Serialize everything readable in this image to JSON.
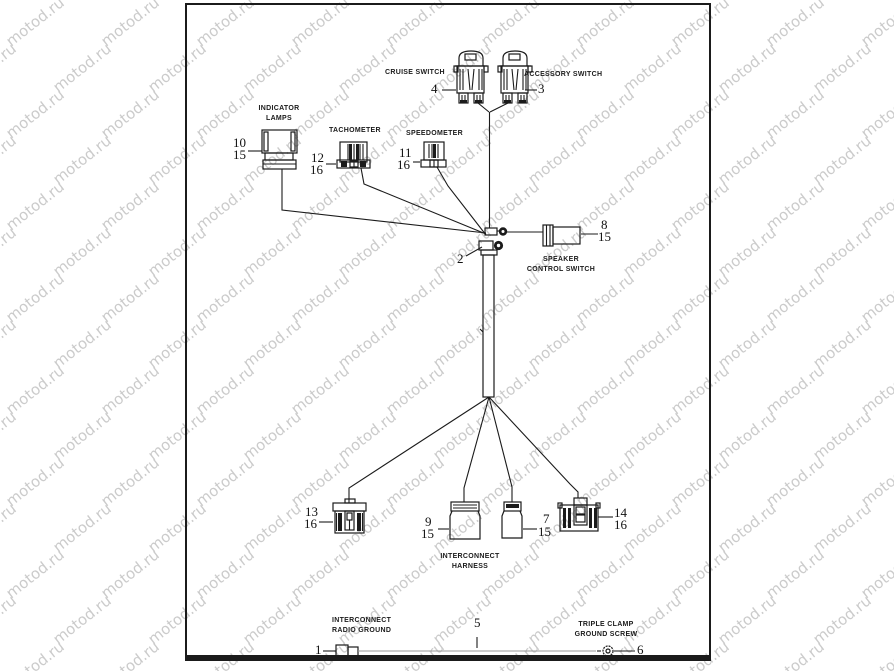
{
  "watermark": {
    "text": "motod.ru",
    "color": "#cbcbcb"
  },
  "labels": {
    "cruise_switch": "CRUISE SWITCH",
    "accessory_switch": "ACCESSORY SWITCH",
    "indicator_lamps": "INDICATOR\nLAMPS",
    "tachometer": "TACHOMETER",
    "speedometer": "SPEEDOMETER",
    "speaker_control_switch": "SPEAKER\nCONTROL SWITCH",
    "interconnect_harness": "INTERCONNECT\nHARNESS",
    "interconnect_radio_ground": "INTERCONNECT\nRADIO GROUND",
    "triple_clamp_ground_screw": "TRIPLE CLAMP\nGROUND SCREW"
  },
  "callouts": {
    "c1": "1",
    "c2": "2",
    "c3": "3",
    "c4": "4",
    "c5": "5",
    "c6": "6",
    "c7": "7",
    "c8": "8",
    "c9": "9",
    "c10": "10",
    "c11": "11",
    "c12": "12",
    "c13": "13",
    "c14": "14",
    "c15": "15",
    "c16": "16"
  }
}
